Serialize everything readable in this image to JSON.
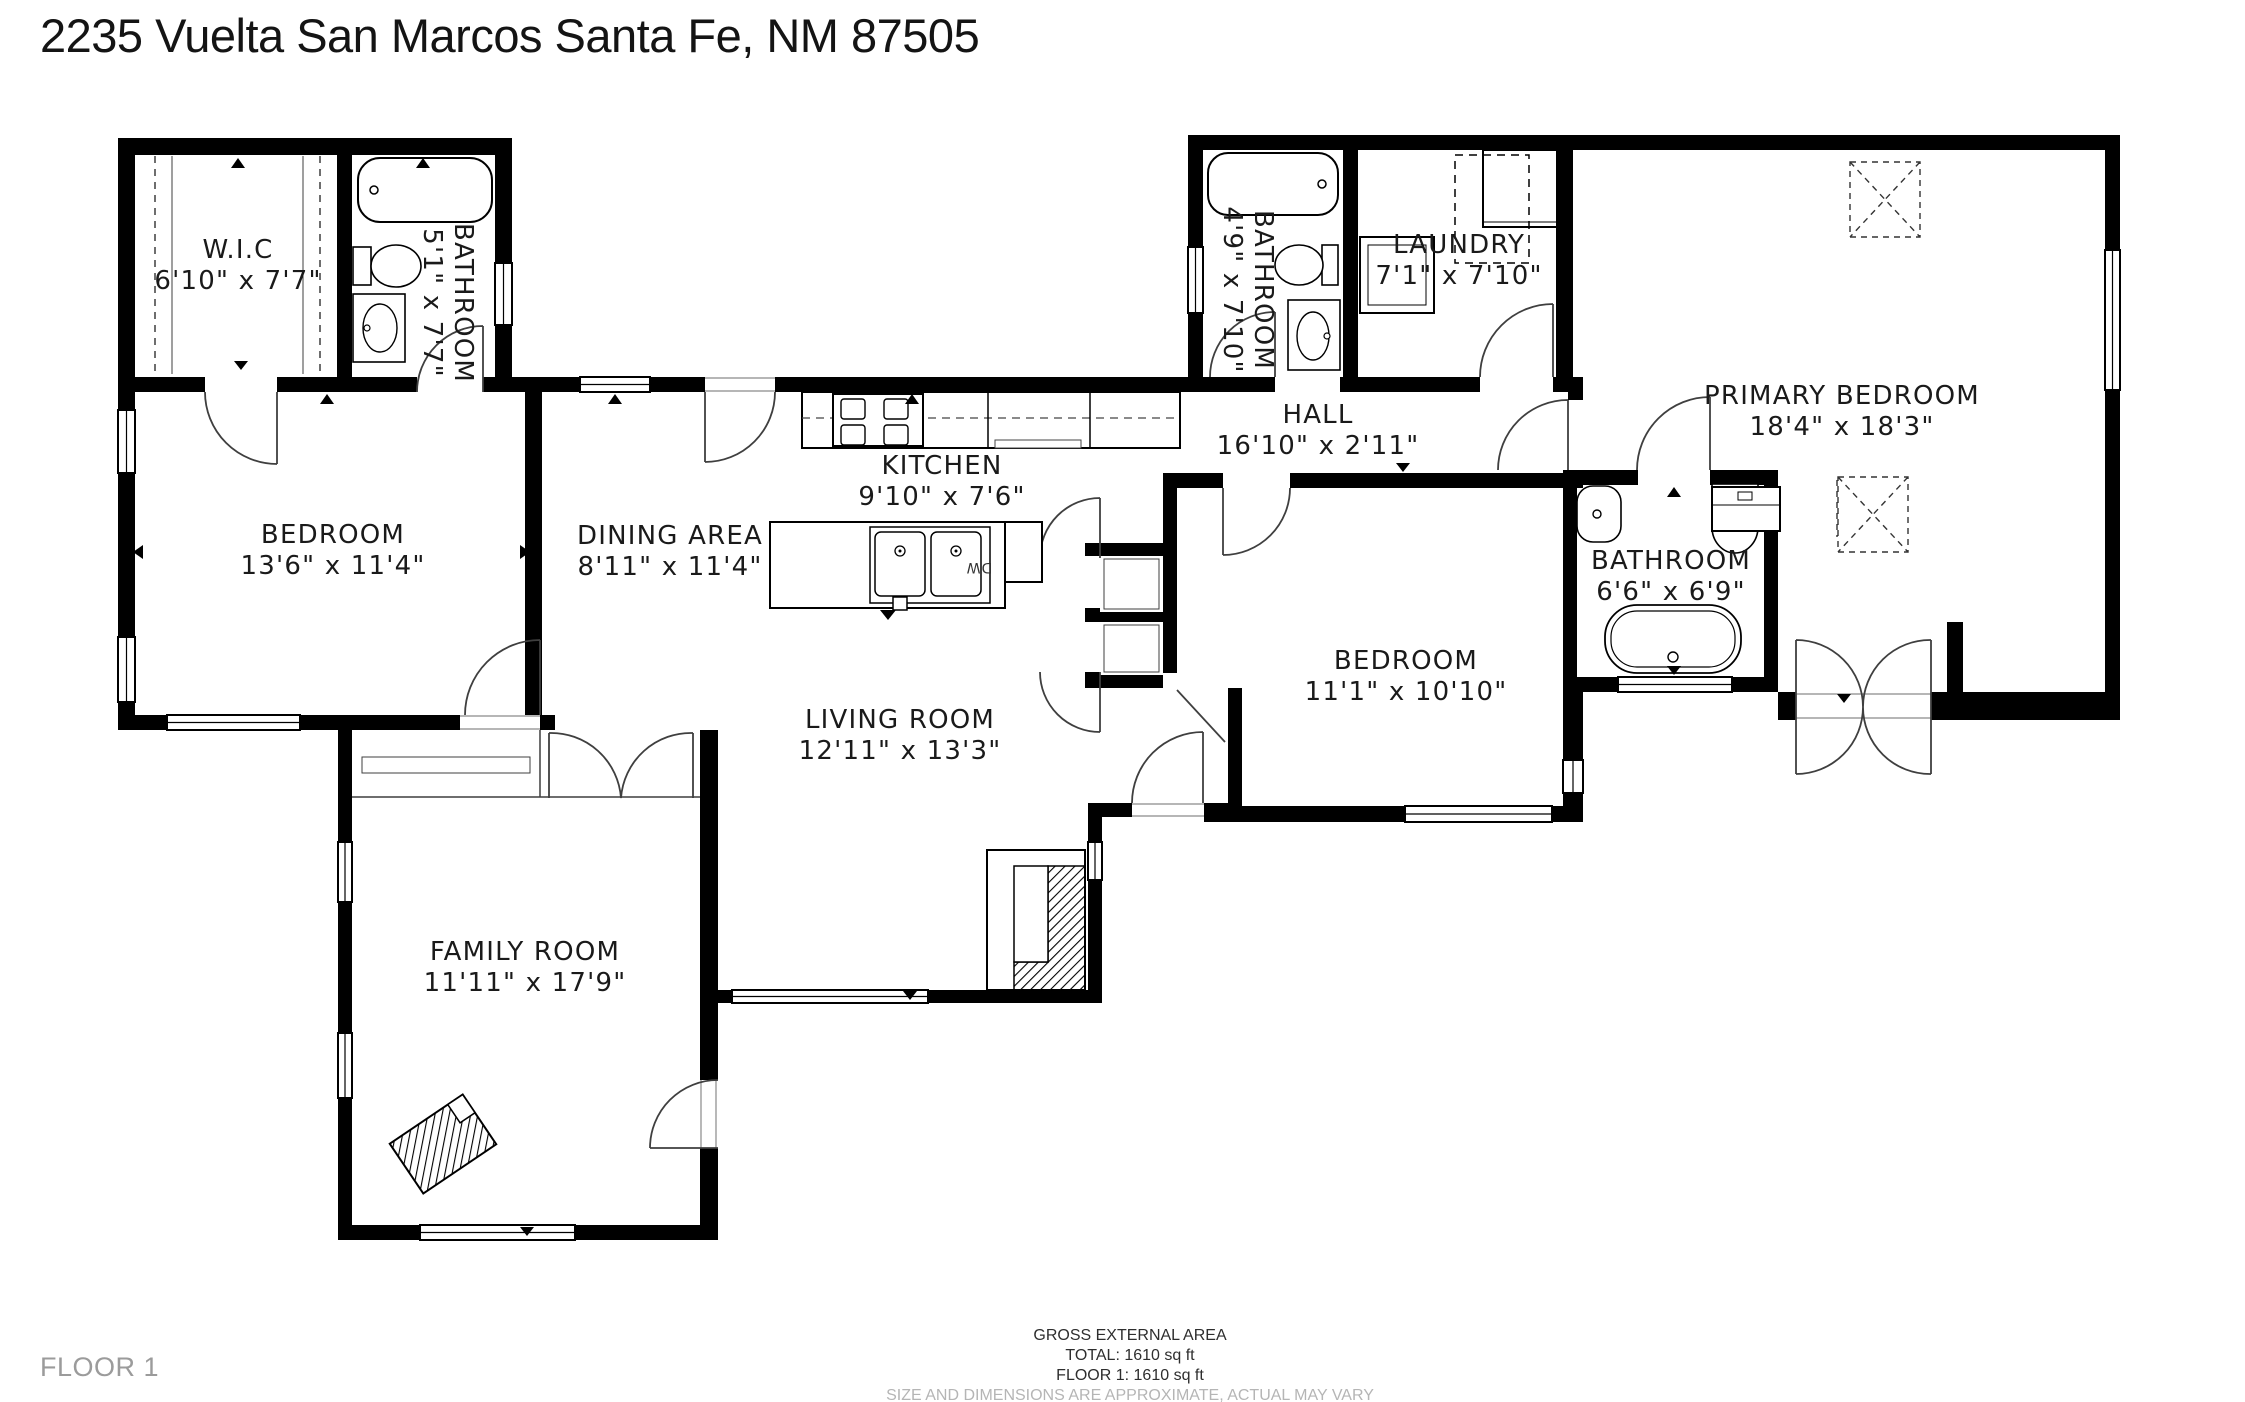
{
  "title": "2235 Vuelta San Marcos Santa Fe, NM 87505",
  "rooms": [
    {
      "name": "W.I.C",
      "dims": "6'10\" x 7'7\""
    },
    {
      "name": "BATHROOM",
      "dims": "5'1\" x 7'7\""
    },
    {
      "name": "BEDROOM",
      "dims": "13'6\" x 11'4\""
    },
    {
      "name": "DINING AREA",
      "dims": "8'11\" x 11'4\""
    },
    {
      "name": "KITCHEN",
      "dims": "9'10\" x 7'6\""
    },
    {
      "name": "LIVING ROOM",
      "dims": "12'11\" x 13'3\""
    },
    {
      "name": "FAMILY ROOM",
      "dims": "11'11\" x 17'9\""
    },
    {
      "name": "HALL",
      "dims": "16'10\" x 2'11\""
    },
    {
      "name": "BATHROOM",
      "dims": "4'9\" x 7'10\""
    },
    {
      "name": "LAUNDRY",
      "dims": "7'1\" x 7'10\""
    },
    {
      "name": "PRIMARY BEDROOM",
      "dims": "18'4\" x 18'3\""
    },
    {
      "name": "BEDROOM",
      "dims": "11'1\" x 10'10\""
    },
    {
      "name": "BATHROOM",
      "dims": "6'6\" x 6'9\""
    }
  ],
  "labels": {
    "dishwasher": "DW"
  },
  "footer": {
    "gross_title": "GROSS EXTERNAL AREA",
    "total": "TOTAL: 1610 sq ft",
    "floor_line": "FLOOR 1: 1610 sq ft",
    "disclaimer": "SIZE AND DIMENSIONS ARE APPROXIMATE, ACTUAL MAY VARY",
    "floor_label": "FLOOR 1"
  },
  "colors": {
    "wall": "#000000",
    "background": "#ffffff",
    "label": "#1a1a1a",
    "muted": "#b5b5b5"
  }
}
